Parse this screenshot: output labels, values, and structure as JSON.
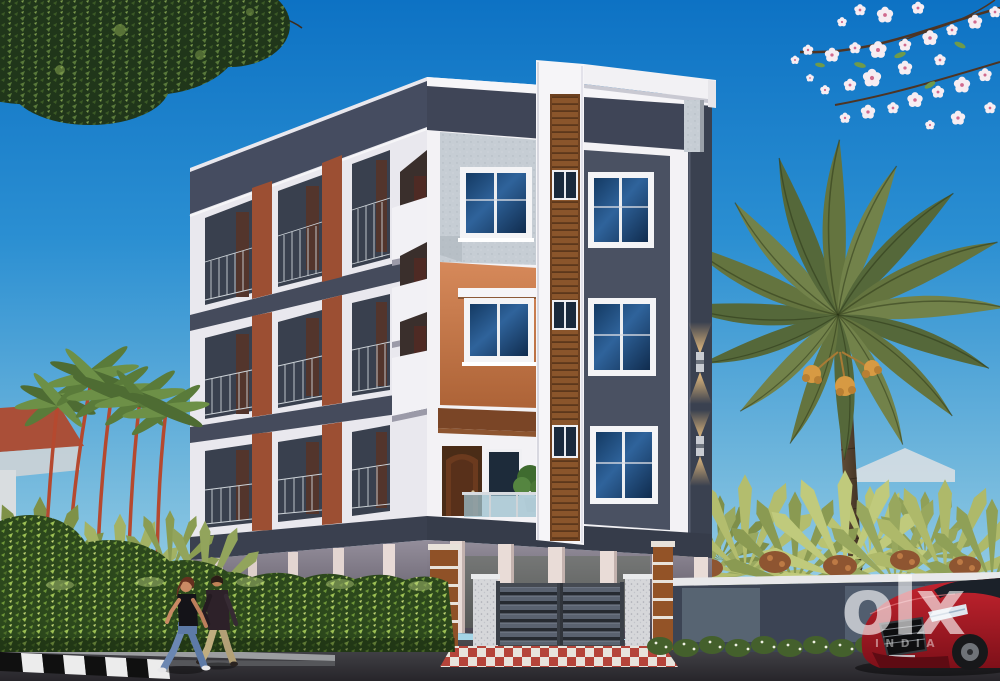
{
  "image": {
    "kind": "3D architectural exterior render",
    "subject": "G+3 apartment building with stilt parking, compound wall and slatted gate",
    "setting": "street scene with hedge, ornamental palms, date palm, pedestrians and a red car"
  },
  "watermark": {
    "logo": "olx",
    "country": "INDIA"
  },
  "palette": {
    "sky_top": "#0d72c4",
    "sky_horizon": "#a7d7e8",
    "wall_white": "#f3f2f5",
    "slate_dark": "#3f4557",
    "stucco_gray": "#c6cdd4",
    "terracotta": "#c9763d",
    "rust_panel": "#9c4f33",
    "wood_slats": "#8a552b",
    "window_glass": "#16365c",
    "gate_gray": "#5a6270",
    "hedge_green": "#2c481c",
    "palm_olive": "#64743f",
    "apron_red": "#b5443a",
    "road_asphalt": "#3a383c",
    "car_red": "#b5202c",
    "sconce_glow": "#ffc979"
  },
  "scene": {
    "elements": [
      "blue sky",
      "tree canopy top-left",
      "cherry blossom branches top-right",
      "white apartment building with slate and terracotta accents",
      "wood-slat feature tower with rooftop pergola beam",
      "balconies with railings",
      "glowing wall sconces",
      "stilt parking columns",
      "compound wall with horizontal-slat double gate",
      "red and white checkered driveway apron",
      "green boundary hedge",
      "red-stemmed ornamental palms",
      "tall date palm with fruit clusters",
      "two pedestrians walking",
      "red car bottom-right",
      "OLX INDIA watermark"
    ]
  }
}
